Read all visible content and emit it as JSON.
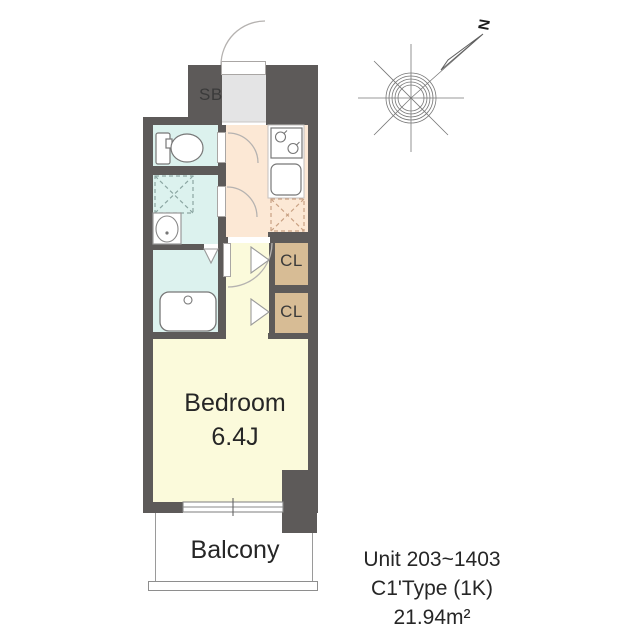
{
  "plan": {
    "labels": {
      "shoe_box": "SB",
      "closet_1": "CL",
      "closet_2": "CL",
      "bedroom_name": "Bedroom",
      "bedroom_size": "6.4J",
      "balcony": "Balcony"
    },
    "compass_north": "N",
    "fixtures": [
      "toilet",
      "washing-machine-space",
      "washbasin",
      "bathtub",
      "stove",
      "kitchen-sink",
      "refrigerator-space",
      "window",
      "entrance-door"
    ]
  },
  "info": {
    "unit_range": "Unit 203~1403",
    "plan_type": "C1'Type (1K)",
    "floor_area": "21.94m²"
  },
  "colors": {
    "wall": "#5d5a59",
    "bedroom_floor": "#fbfadb",
    "kitchen_floor": "#fce8d5",
    "wet_area_floor": "#dcf2ee",
    "storage": "#d7bc95",
    "entrance_floor": "#e4e4e5"
  }
}
